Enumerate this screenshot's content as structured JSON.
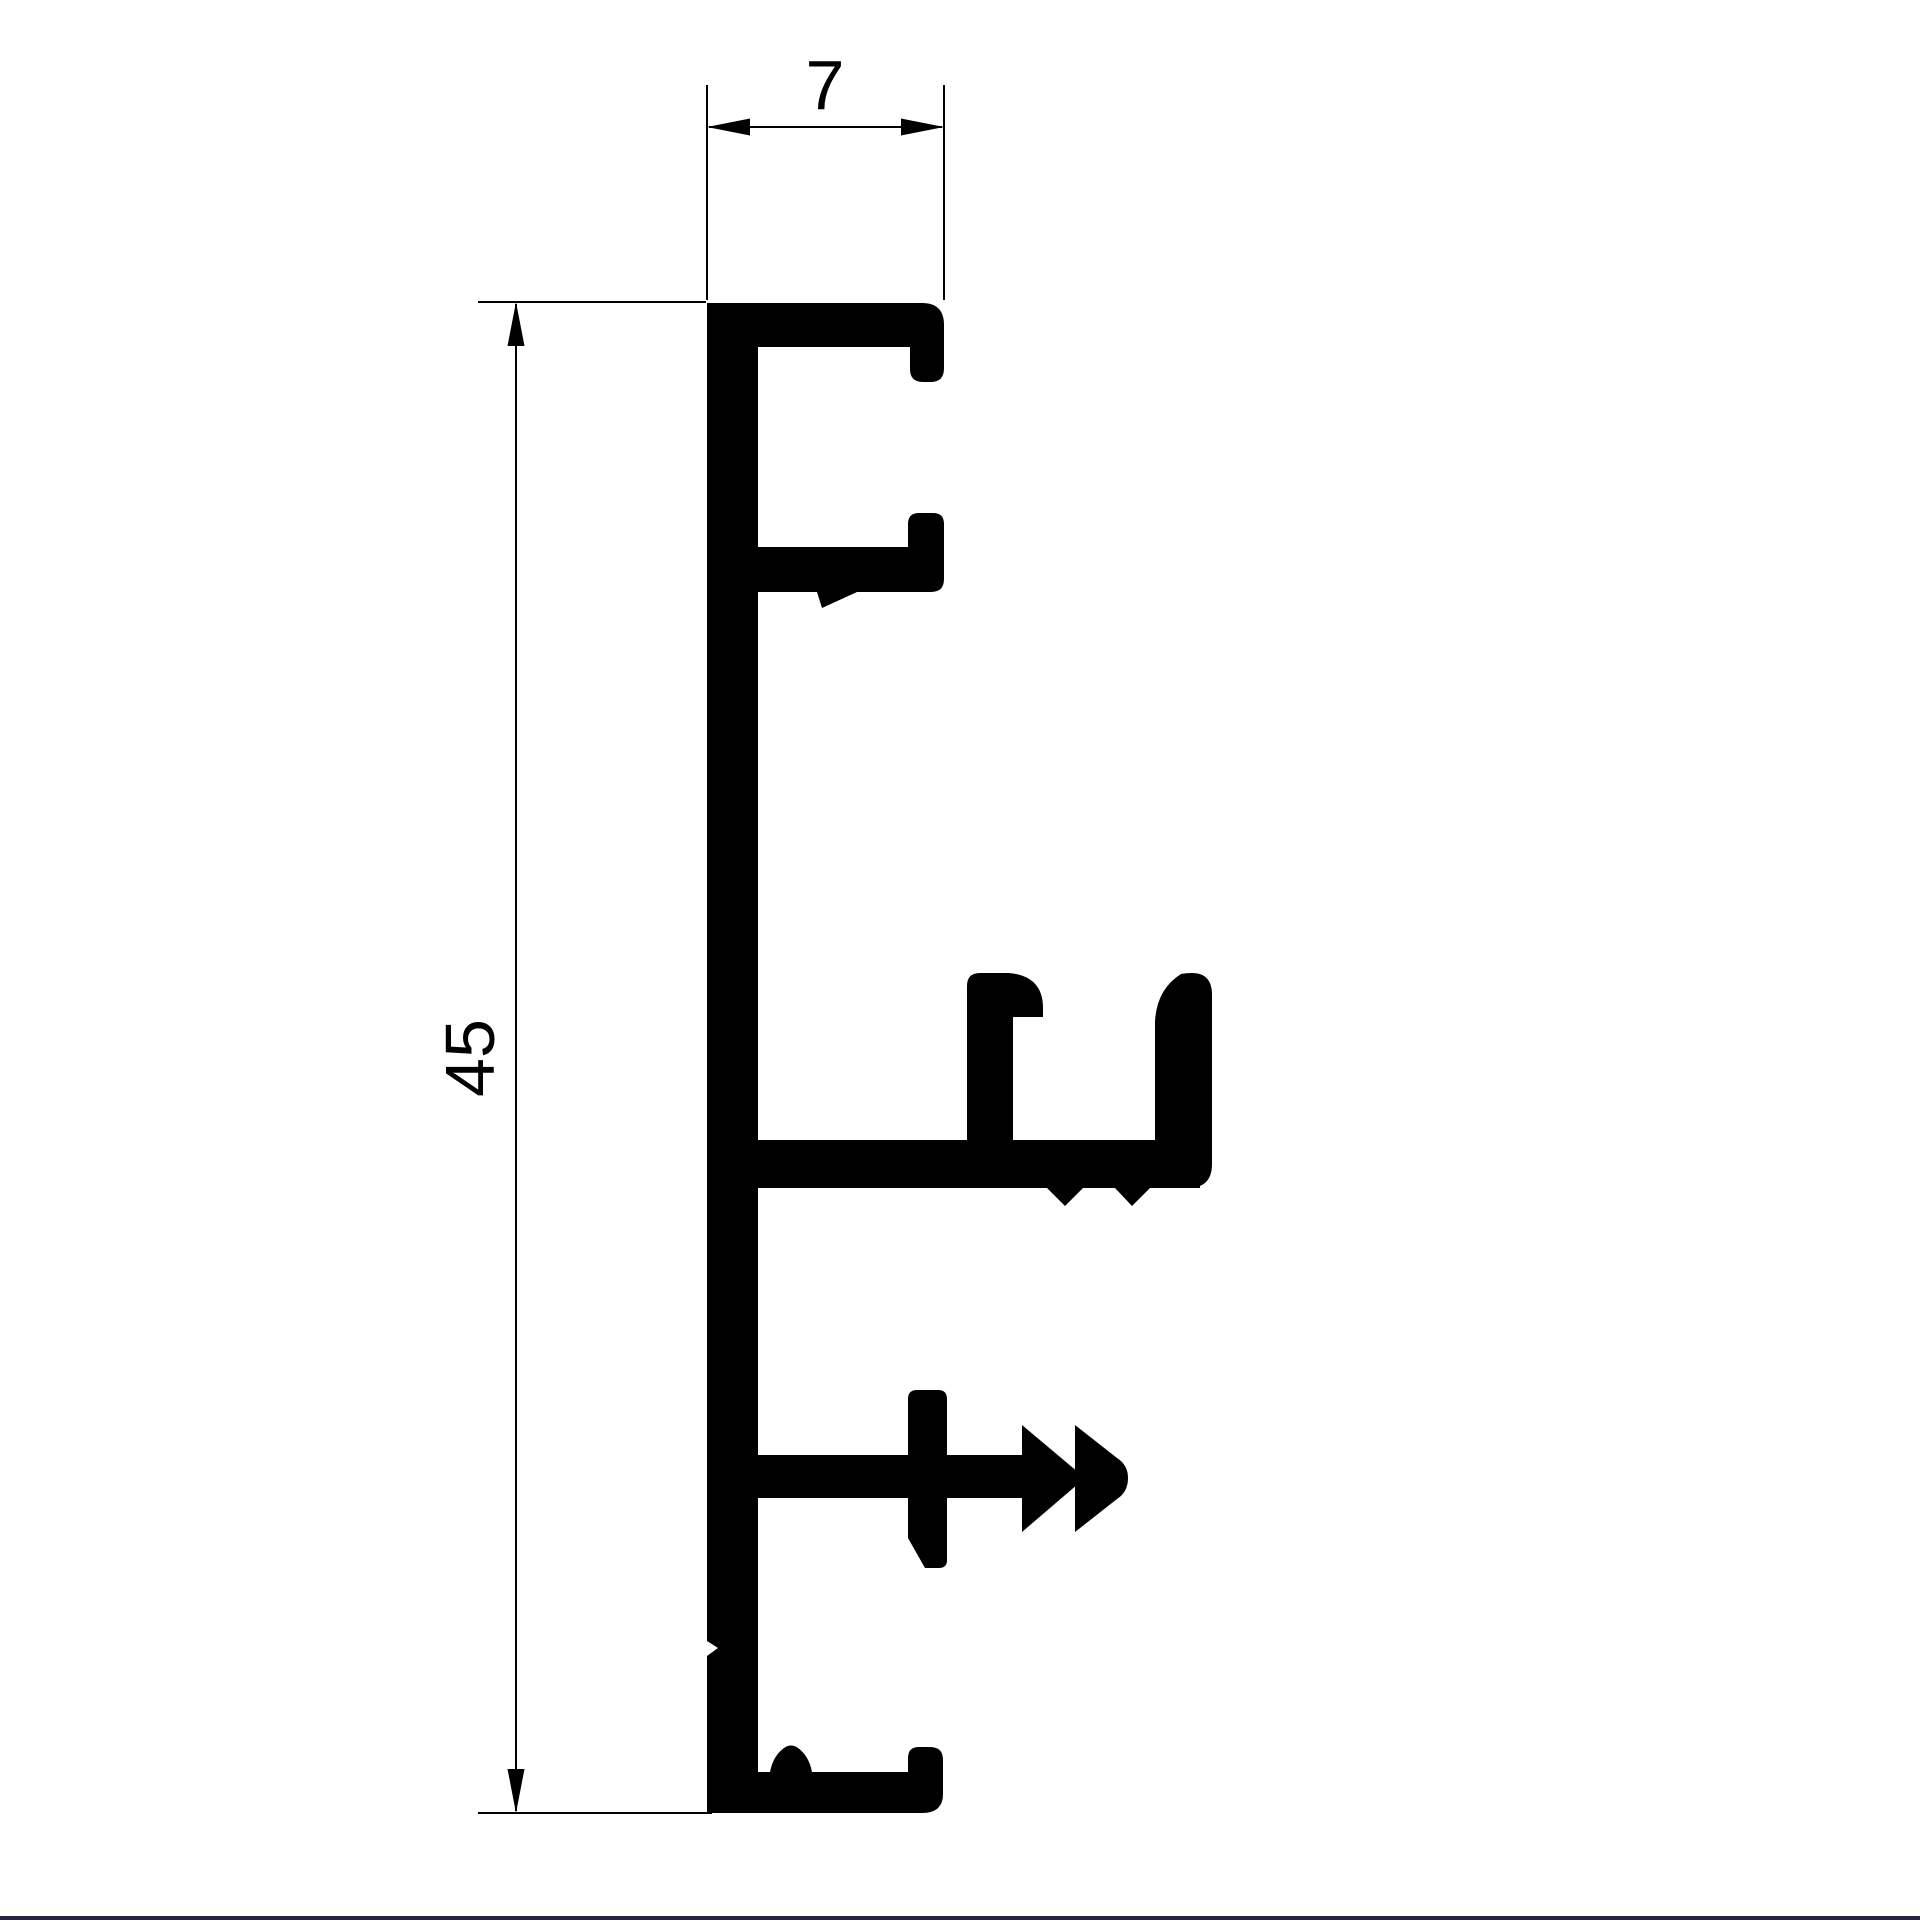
{
  "drawing": {
    "background_color": "#ffffff",
    "line_color": "#000000",
    "bottom_border_color": "#262440",
    "dimensions": {
      "width_label": "7",
      "height_label": "45"
    }
  }
}
